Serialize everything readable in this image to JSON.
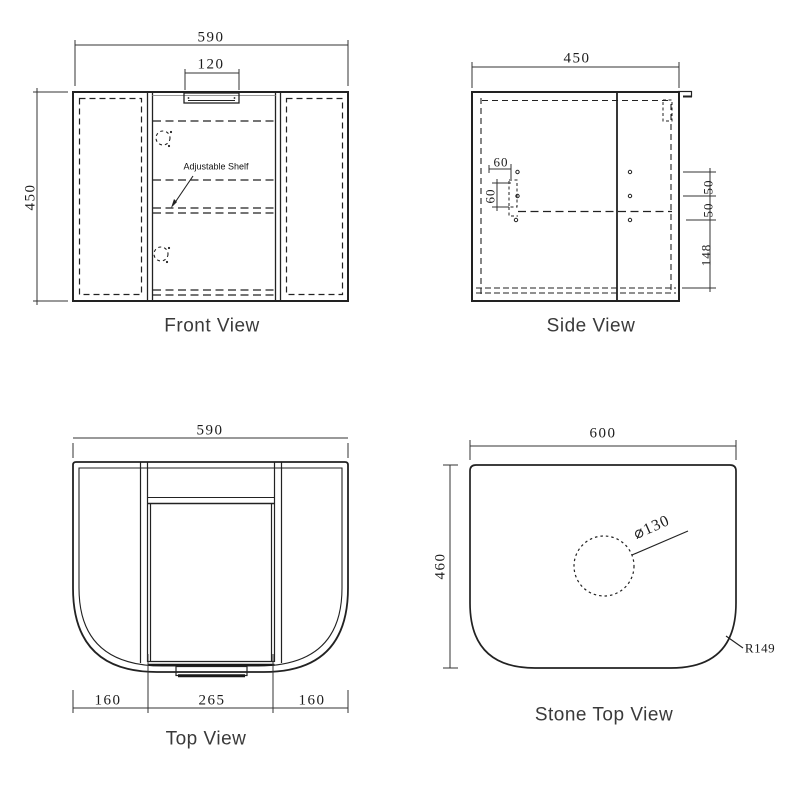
{
  "front_view": {
    "title": "Front View",
    "dim_width": "590",
    "dim_height": "450",
    "dim_handle_width": "120",
    "shelf_label": "Adjustable Shelf"
  },
  "side_view": {
    "title": "Side View",
    "dim_depth": "450",
    "dim_hinge_inset": "60",
    "dim_hinge_spacing": "60",
    "dim_hole_gap_1": "50",
    "dim_hole_gap_2": "50",
    "dim_bottom_offset": "148"
  },
  "top_view": {
    "title": "Top View",
    "dim_width": "590",
    "dim_left_panel": "160",
    "dim_door": "265",
    "dim_right_panel": "160"
  },
  "stone_top_view": {
    "title": "Stone Top View",
    "dim_width": "600",
    "dim_depth": "460",
    "tap_hole_diameter": "⌀130",
    "corner_radius": "R149"
  },
  "colors": {
    "line": "#222222",
    "dim_line": "#333333",
    "title_text": "#3a3a3a",
    "background": "#ffffff"
  }
}
